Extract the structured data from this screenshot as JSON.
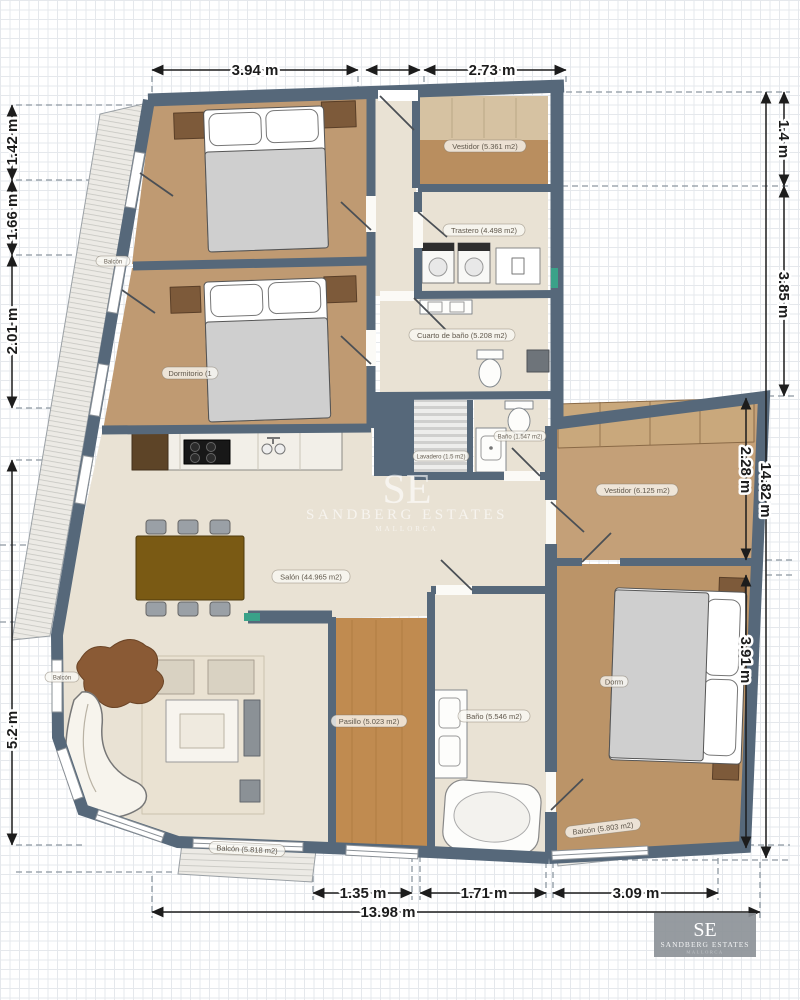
{
  "watermark": {
    "initials": "SE",
    "name": "SANDBERG ESTATES",
    "subtitle": "MALLORCA"
  },
  "logo": {
    "initials": "SE",
    "name": "SANDBERG ESTATES",
    "subtitle": "MALLORCA"
  },
  "rooms": {
    "vestidor_top": {
      "label": "Vestidor (5.361 m2)"
    },
    "trastero": {
      "label": "Trastero (4.498 m2)"
    },
    "cuarto_bano": {
      "label": "Cuarto de baño (5.208 m2)"
    },
    "lavadero": {
      "label": "Lavadero (1.5 m2)"
    },
    "bano_small": {
      "label": "Baño (1.547 m2)"
    },
    "dormitorio_left": {
      "label": "Dormitorio (1"
    },
    "salon": {
      "label": "Salón (44.965 m2)"
    },
    "pasillo": {
      "label": "Pasillo (5.023 m2)"
    },
    "bano_principal": {
      "label": "Baño (5.546 m2)"
    },
    "vestidor_right": {
      "label": "Vestidor (6.125 m2)"
    },
    "dormitorio_right": {
      "label": "Dorm"
    },
    "balcon_salon": {
      "label": "Balcón (5.818 m2)"
    },
    "balcon_dormitorio": {
      "label": "Balcón (5.803 m2)"
    },
    "balcon_left_upper": {
      "label": "Balcón"
    },
    "balcon_left_lower": {
      "label": "Balcón"
    }
  },
  "dimensions": {
    "top": [
      "3.94 m",
      "2.73 m"
    ],
    "bottom": [
      "1.35 m",
      "1.71 m",
      "3.09 m",
      "13.98 m"
    ],
    "left": [
      "1.42 m",
      "1.66 m",
      "2.01 m",
      "5.2 m"
    ],
    "right": [
      "1.4 m",
      "3.85 m",
      "2.28 m",
      "14.82 m",
      "3.91 m"
    ]
  },
  "colors": {
    "wall": "#56687a",
    "wood": "#bf9a72",
    "wood_dark": "#c08b50",
    "plaster": "#e9e2d4",
    "accent_teal": "#3aa289"
  }
}
